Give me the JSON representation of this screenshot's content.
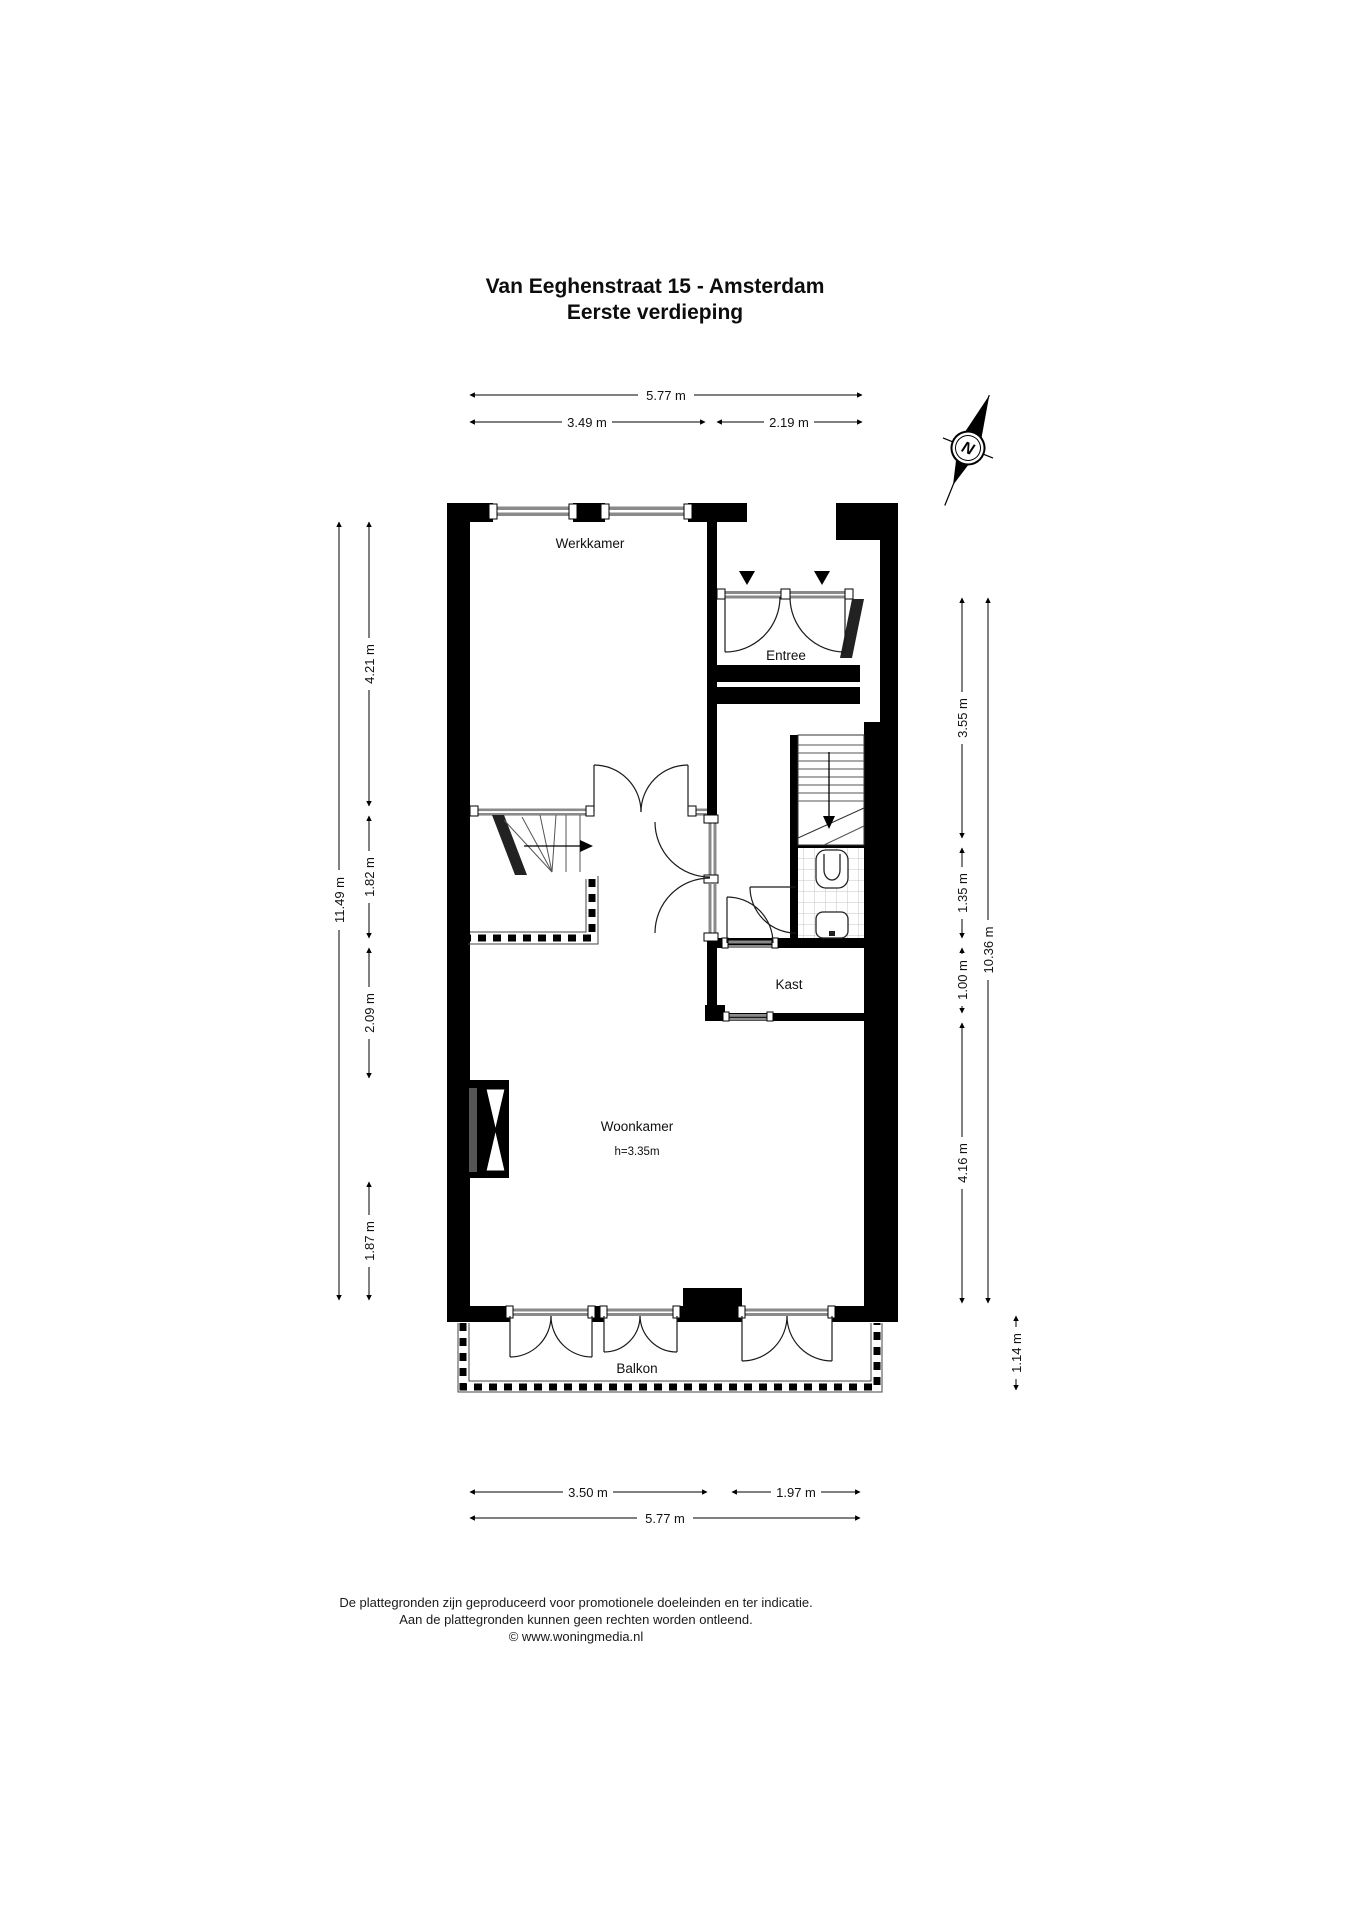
{
  "title": {
    "line1": "Van Eeghenstraat 15 - Amsterdam",
    "line2": "Eerste verdieping"
  },
  "rooms": {
    "werkkamer": "Werkkamer",
    "entree": "Entree",
    "kast": "Kast",
    "woonkamer": "Woonkamer",
    "woonkamer_ceiling": "h=3.35m",
    "balkon": "Balkon"
  },
  "dims": {
    "top_total": "5.77 m",
    "top_left": "3.49 m",
    "top_right": "2.19 m",
    "left_total": "11.49 m",
    "left_1": "4.21 m",
    "left_2": "1.82 m",
    "left_3": "2.09 m",
    "left_4": "1.87 m",
    "right_1": "3.55 m",
    "right_2": "1.35 m",
    "right_3": "1.00 m",
    "right_4": "4.16 m",
    "right_total": "10.36 m",
    "balcony_depth": "1.14 m",
    "bottom_left": "3.50 m",
    "bottom_right": "1.97 m",
    "bottom_total": "5.77 m"
  },
  "compass": {
    "north_label": "N"
  },
  "footer": {
    "line1": "De plattegronden zijn geproduceerd voor promotionele doeleinden en ter indicatie.",
    "line2": "Aan de plattegronden kunnen geen rechten worden ontleend.",
    "line3": "© www.woningmedia.nl"
  },
  "colors": {
    "wall": "#000000",
    "glass": "#8a8a8a",
    "tile_line": "#c4c4c4",
    "paper": "#ffffff"
  }
}
